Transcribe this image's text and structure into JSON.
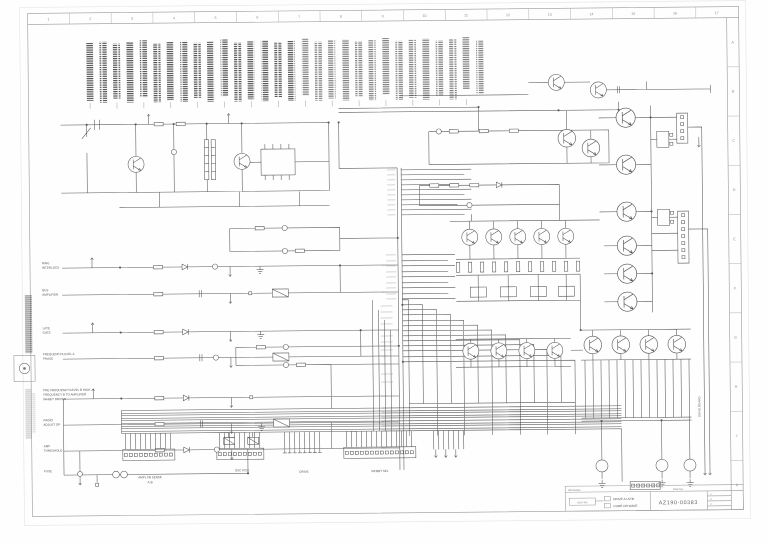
{
  "sheet": {
    "grid_top": [
      "1",
      "2",
      "3",
      "4",
      "5",
      "6",
      "7",
      "8",
      "9",
      "10",
      "11",
      "12",
      "13",
      "14",
      "15",
      "16",
      "17"
    ],
    "grid_right": [
      "A",
      "B",
      "C",
      "D",
      "E",
      "F",
      "G",
      "H",
      "J",
      "K"
    ]
  },
  "title_block": {
    "header_left": "REVISIONS",
    "header_mid": "DWG NO.",
    "assy_box": "ASSY NO",
    "line1": "DRIVE A LSTB",
    "line2": "CORE OR WAVE",
    "drawing_number": "AZ190-00383",
    "revisions": [
      "A",
      "B",
      "C"
    ]
  },
  "left_labels": [
    {
      "line1": "RING",
      "line2": "INTERLOCK"
    },
    {
      "line1": "BUS",
      "line2": "AMPLIFIER"
    },
    {
      "line1": "LATE",
      "line2": "GATE"
    },
    {
      "line1": "FREQUENCY/LEVEL A",
      "line2": "PHASE"
    },
    {
      "line1": "PRE FREQUENCY/LEVEL B HIGH",
      "line2": "FREQUENCY B TO AMPLIFIER",
      "line3": "INHIBIT DRIVER"
    },
    {
      "line1": "RADIO",
      "line2": "ADJUST OP"
    },
    {
      "line1": "AMP",
      "line2": "THRESHOLD"
    },
    {
      "line1": "FUSE",
      "line2": ""
    }
  ],
  "connectors": [
    {
      "label": "AMPL FB SENSE",
      "sub": "A-B"
    },
    {
      "label": "OSC PICK",
      "sub": ""
    },
    {
      "label": "DRIVE",
      "sub": ""
    },
    {
      "label": "INHIBIT SEL",
      "sub": ""
    }
  ],
  "side_note": "DRIVE BOARD"
}
